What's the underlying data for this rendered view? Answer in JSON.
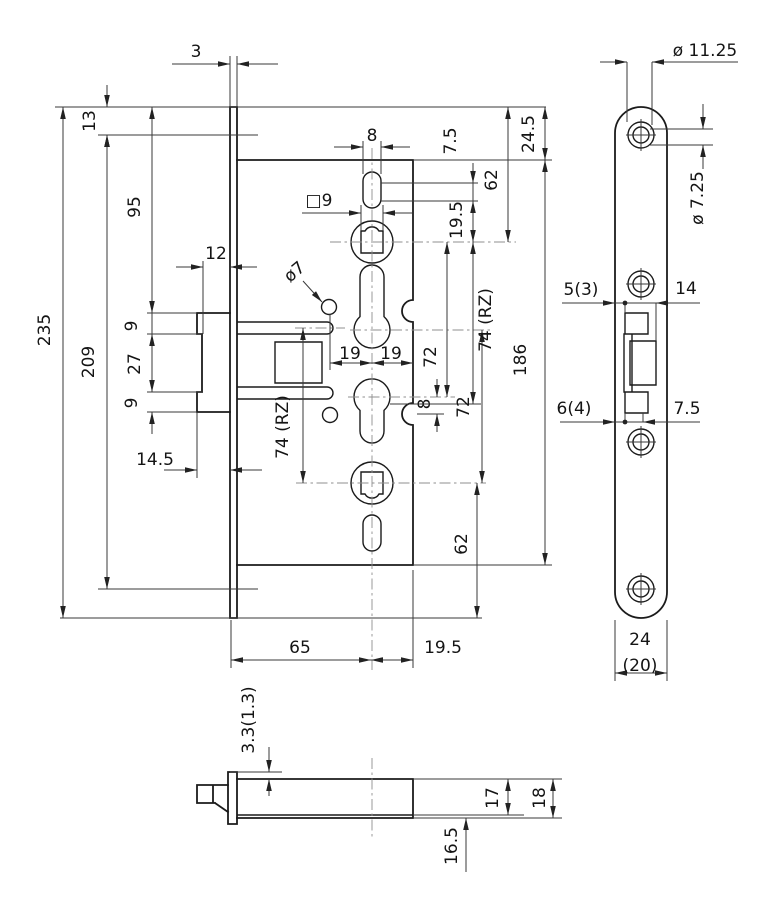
{
  "drawing": {
    "type": "technical-drawing",
    "subject": "mortise-lock-dimension-drawing",
    "line_color": "#1b1b1b",
    "background": "#ffffff"
  },
  "dims": {
    "face_plate_thickness": "3",
    "plate_top_to_screw": "13",
    "lead_95": "95",
    "plate_length": "235",
    "screw_spacing": "209",
    "latch_seg_top": "9",
    "latch_seg_mid": "27",
    "latch_seg_bot": "9",
    "step_12": "12",
    "latch_projection": "14.5",
    "slot_width_8": "8",
    "follower_square": "□9",
    "pin_dia": "ø7",
    "cyl_offset_left": "19",
    "cyl_offset_right": "19",
    "rz_distance_left": "74 (RZ)",
    "rz_distance_right": "74 (RZ)",
    "distance_72_upper": "72",
    "distance_72_lower": "72",
    "rz_offset_8": "8",
    "entf_top": "62",
    "entf_bottom": "62",
    "oval_7_5": "7.5",
    "oval_19_5": "19.5",
    "case_offset_24_5": "24.5",
    "case_length": "186",
    "backset_65": "65",
    "case_offset_19_5": "19.5",
    "screw_head_dia": "ø 11.25",
    "screw_hole_dia": "ø 7.25",
    "cutout_5_3": "5(3)",
    "cutout_14": "14",
    "cutout_6_4": "6(4)",
    "cutout_7_5": "7.5",
    "plate_width_24": "24",
    "plate_width_20": "(20)",
    "lid_3_3": "3.3(1.3)",
    "depth_16_5": "16.5",
    "depth_17": "17",
    "depth_18": "18"
  }
}
